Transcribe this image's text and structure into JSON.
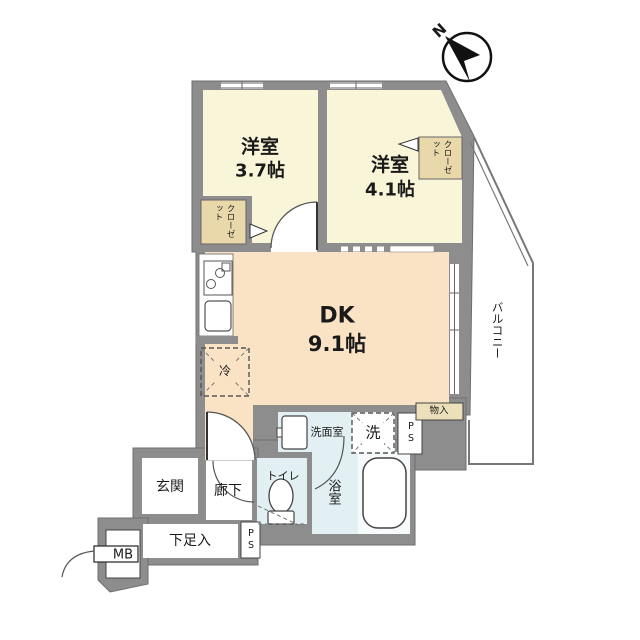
{
  "plan": {
    "compass": {
      "north_label": "N"
    },
    "rooms": {
      "bedroom1": {
        "name": "洋室",
        "size": "3.7帖"
      },
      "bedroom2": {
        "name": "洋室",
        "size": "4.1帖"
      },
      "dk": {
        "name": "DK",
        "size": "9.1帖"
      },
      "balcony": {
        "label": "バルコニー"
      },
      "closet1": {
        "label": "クローゼット"
      },
      "closet2": {
        "label": "クローゼット"
      },
      "fridge": {
        "label": "冷"
      },
      "washroom": {
        "label": "洗面室"
      },
      "washer": {
        "label": "洗"
      },
      "pipe_space_upper": {
        "label": "PS"
      },
      "pipe_space_lower": {
        "label": "PS"
      },
      "storage": {
        "label": "物入"
      },
      "toilet": {
        "label": "トイレ"
      },
      "bath": {
        "label": "浴室"
      },
      "entrance": {
        "label": "玄関"
      },
      "corridor": {
        "label": "廊下"
      },
      "shoe_storage": {
        "label": "下足入"
      },
      "meter_box": {
        "label": "MB"
      }
    },
    "colors": {
      "wall": "#8d8d8d",
      "bedroom": "#f8f5d8",
      "dk": "#fae3c5",
      "water": "#e2eff3",
      "closet": "#e8d8aa",
      "storage_box": "#ece0ba"
    }
  }
}
